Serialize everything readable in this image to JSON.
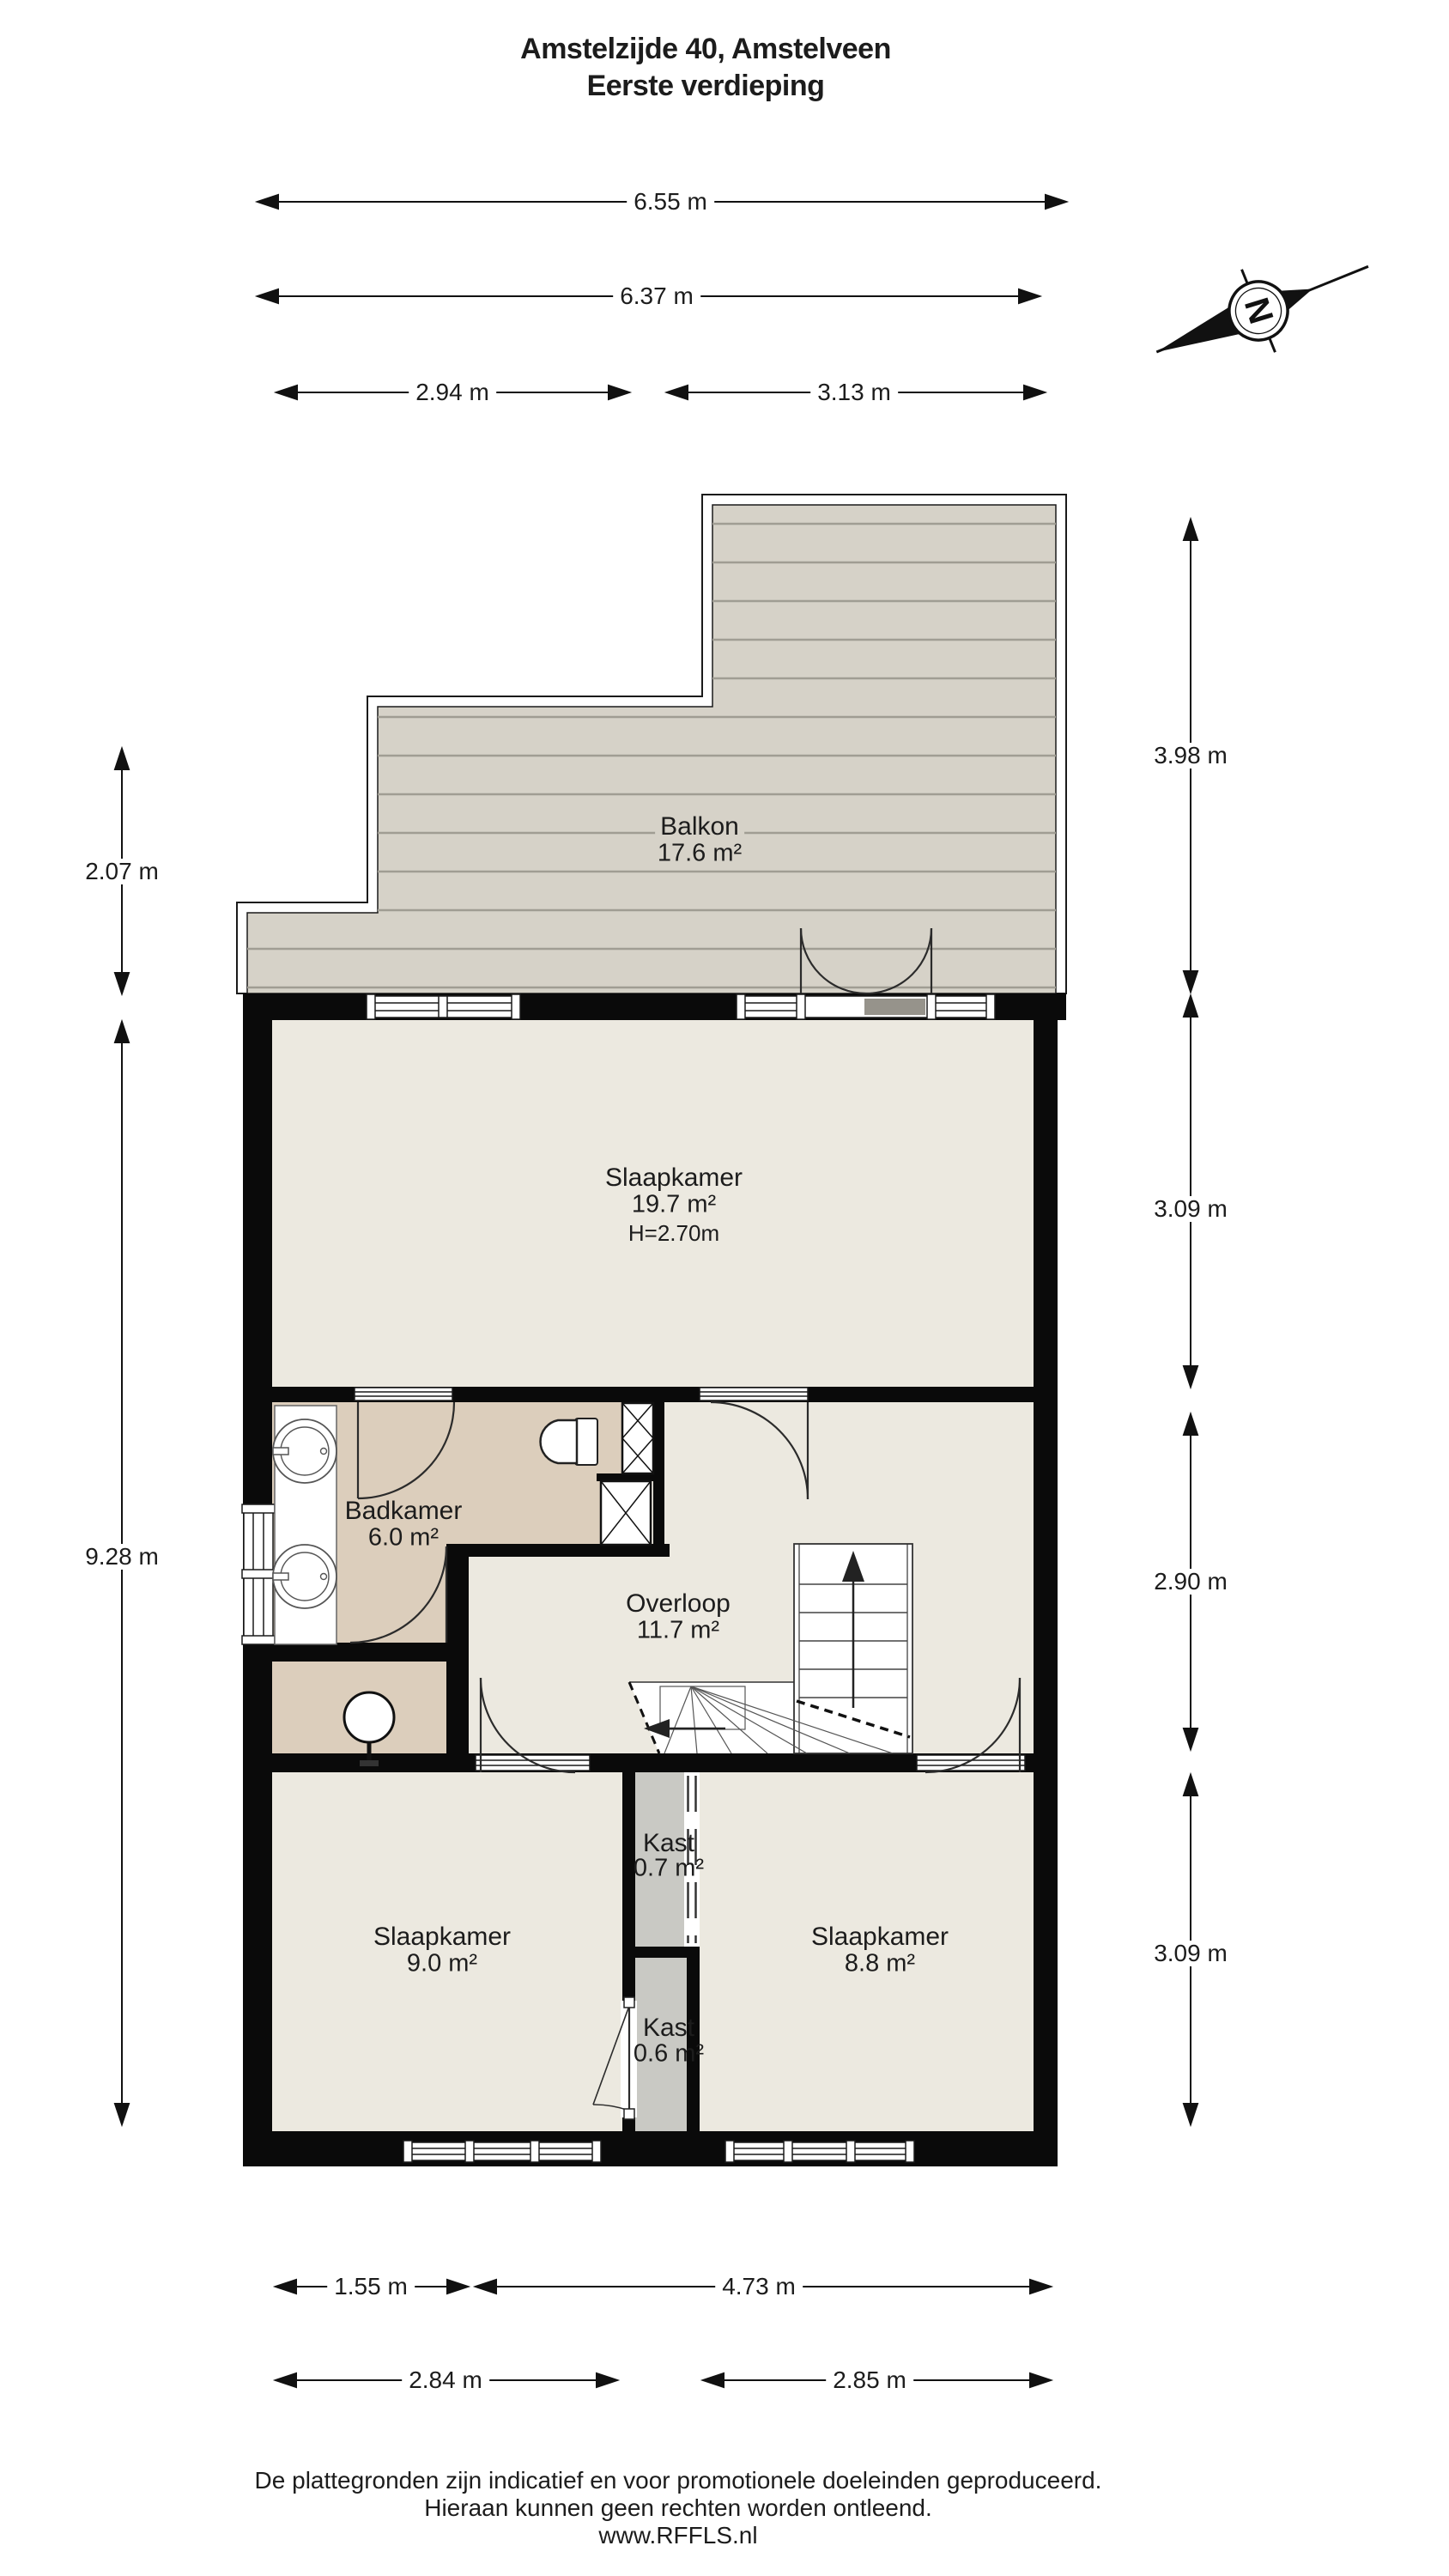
{
  "title": {
    "line1": "Amstelzijde 40, Amstelveen",
    "line2": "Eerste verdieping"
  },
  "compass": {
    "letter": "N"
  },
  "rooms": {
    "balkon": {
      "name": "Balkon",
      "area": "17.6 m²"
    },
    "slaapkamer_groot": {
      "name": "Slaapkamer",
      "area": "19.7 m²",
      "height": "H=2.70m"
    },
    "badkamer": {
      "name": "Badkamer",
      "area": "6.0 m²"
    },
    "overloop": {
      "name": "Overloop",
      "area": "11.7 m²"
    },
    "kast_boven": {
      "name": "Kast",
      "area": "0.7 m²"
    },
    "slaapkamer_links": {
      "name": "Slaapkamer",
      "area": "9.0 m²"
    },
    "slaapkamer_rechts": {
      "name": "Slaapkamer",
      "area": "8.8 m²"
    },
    "kast_onder": {
      "name": "Kast",
      "area": "0.6 m²"
    }
  },
  "dimensions": {
    "top": [
      "6.55 m",
      "6.37 m",
      "2.94 m",
      "3.13 m"
    ],
    "right": [
      "3.98 m",
      "3.09 m",
      "2.90 m",
      "3.09 m"
    ],
    "left": [
      "2.07 m",
      "9.28 m"
    ],
    "bottom": [
      "1.55 m",
      "4.73 m",
      "2.84 m",
      "2.85 m"
    ]
  },
  "footer": {
    "line1": "De plattegronden zijn indicatief en voor promotionele doeleinden geproduceerd.",
    "line2": "Hieraan kunnen geen rechten worden ontleend.",
    "line3": "www.RFFLS.nl"
  },
  "colors": {
    "wall": "#0a0a0a",
    "floor": "#ece9e0",
    "bathroom_floor": "#dccebc",
    "closet_floor": "#c9c9c4",
    "balcony_deck": "#d6d2c8",
    "deck_stripe": "#a09d93",
    "text": "#1c1c1c"
  }
}
